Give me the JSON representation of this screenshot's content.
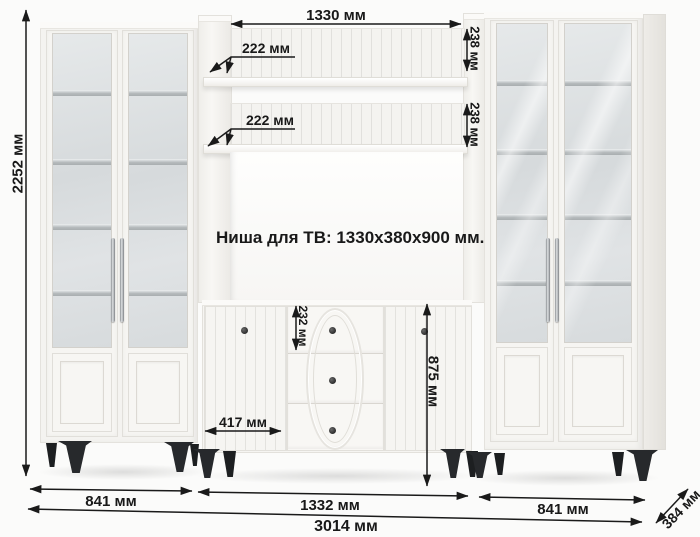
{
  "diagram": {
    "tv_niche_label": "Ниша для ТВ: 1330x380x900 мм.",
    "dimensions": {
      "height_total": "2252 мм",
      "shelf_width": "1330 мм",
      "shelf_depth_top": "222 мм",
      "shelf_depth_mid": "222 мм",
      "shelf_gap_top": "238 мм",
      "shelf_gap_mid": "238 мм",
      "drawer_height": "232 мм",
      "tv_stand_height": "875 мм",
      "door_width": "417 мм",
      "width_left": "841 мм",
      "width_center": "1332 мм",
      "width_right": "841 мм",
      "width_total": "3014 мм",
      "depth": "384 мм"
    },
    "colors": {
      "background": "#fbfbfa",
      "furniture_white": "#f5f4f1",
      "glass": "#d9dcde",
      "legs_black": "#27292c",
      "dimension_ink": "#1a1a1a"
    }
  }
}
